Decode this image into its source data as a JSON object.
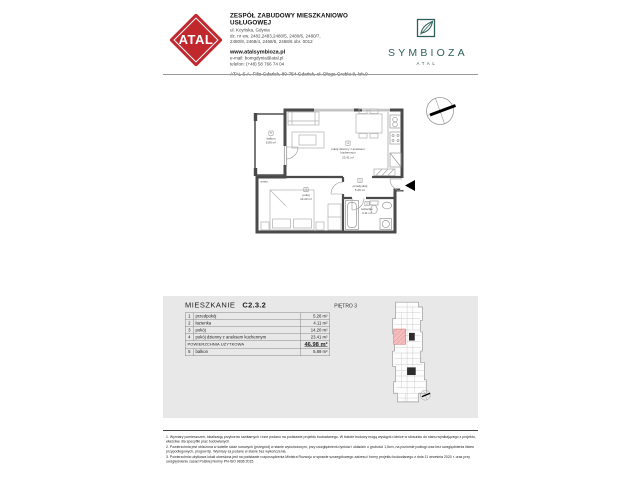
{
  "colors": {
    "accent_red": "#c0282e",
    "brand_teal": "#2e5f5b",
    "panel_grey": "#e8e8e8",
    "unit_highlight": "#f5bdbd"
  },
  "header": {
    "logo_text": "ATAL",
    "title": "ZESPÓŁ ZABUDOWY MIESZKANIOWO USŁUGOWEJ",
    "address_line1": "ul. Kcyńska, Gdynia",
    "address_line2": "dz. nr ew. 2482,2483,2480/5, 2480/6, 2480/7,",
    "address_line3": "2480/8, 2468/4, 2468/5, 2468/6  obr. 0012",
    "website": "www.atalsymbioza.pl",
    "email": "e-mail:  bomgdynia@atal.pl",
    "phone": "telefon: (+48) 58 766 74 04",
    "office": "ATAL S.A. Filia Gdańsk, 80-754 Gdańsk, ul. Długa Grobla 8, lok.9",
    "brand_name": "SYMBIOZA",
    "brand_sub": "ATAL"
  },
  "plan": {
    "balkon": {
      "no": "5",
      "name": "balkon",
      "area": "5.89 m²"
    },
    "living": {
      "no": "4",
      "name_line1": "pokój dzienny z aneksem",
      "name_line2": "kuchennym",
      "area": "23.41 m²"
    },
    "pokoj": {
      "no": "3",
      "name": "pokój",
      "area": "14.20 m²"
    },
    "przedpokoj": {
      "no": "1",
      "name": "przedpokój",
      "area": "5.26 m²"
    },
    "lazienka": {
      "no": "2",
      "name": "łazienka",
      "area": "4.11 m²"
    },
    "niche": "wnęka"
  },
  "table": {
    "title": "MIESZKANIE",
    "unit": "C2.3.2",
    "floor": "PIĘTRO 3",
    "rows": [
      {
        "no": "1",
        "name": "przedpokój",
        "area": "5.26 m²"
      },
      {
        "no": "2",
        "name": "łazienka",
        "area": "4.11 m²"
      },
      {
        "no": "3",
        "name": "pokój",
        "area": "14.20 m²"
      },
      {
        "no": "4",
        "name": "pokój dzienny z aneksem kuchennym",
        "area": "23.41 m²"
      }
    ],
    "total_label": "POWIERZCHNIA UŻYTKOWA",
    "total_area": "46.98 m²",
    "balcony_row": {
      "no": "5",
      "name": "balkon",
      "area": "5.89 m²"
    }
  },
  "footnotes": {
    "item1": "1. Wymiary pomieszczeń, lokalizację przyborów sanitarnych i inne podano na podstawie projektu budowlanego. W trakcie budowy mogą wystąpić różnice w stosunku do stanu wynikającego z projektu, właściwe dla specyfiki prac budowlanych.",
    "item2": "2. Powierzchnia jest obliczona w świetle ścian surowych (przegród) w stanie wykończonym, przy uwzględnieniu tynków i okładzin o grubości 1,5cm, na poziomie podłogi oraz bez uwzględnienia listew przypodłogowych, progów itp. Wymiary są podane w stanie bez wykończenia.",
    "item3": "3. Powierzchnia użytkowa lokali określona jest na podstawie rozporządzenia Ministra Rozwoju w sprawie szczegółowego zakresu i formy projektu budowlanego z dnia 11 września 2020 r. oraz przy uwzględnieniu zasad Polskiej Normy PN-ISO 9836:2015."
  }
}
